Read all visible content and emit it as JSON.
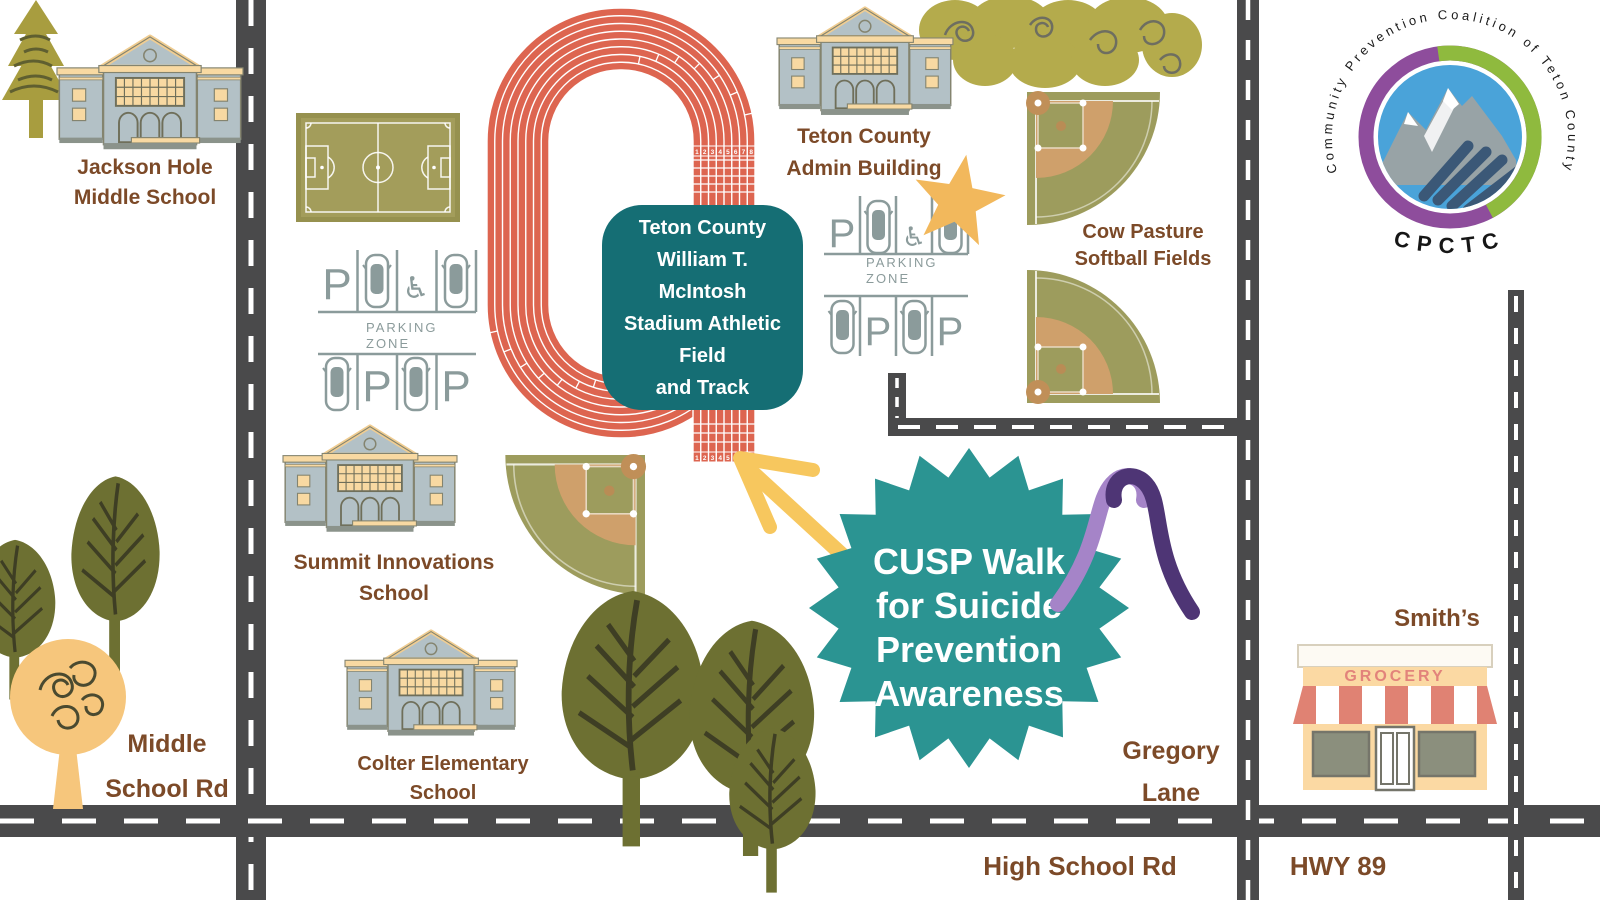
{
  "palette": {
    "road": "#4a4a4b",
    "track_orange": "#dd6550",
    "field_olive": "#9d9c5d",
    "infield_tan": "#cfa06b",
    "label_brown": "#7c4a28",
    "stadium_teal": "#156e74",
    "badge_teal": "#2b9492",
    "arrow_yellow": "#f7c75e",
    "star_yellow": "#f2b85c",
    "ribbon_light_purple": "#a584c8",
    "ribbon_dark_purple": "#4e3575",
    "parking_gray": "#8b9b9b",
    "building_body": "#b3c1c6",
    "building_trim": "#f8d9a2",
    "grocery_red": "#e08273",
    "logo_purple": "#8e4d9c",
    "logo_green": "#8fba3e",
    "logo_blue": "#4aa3d9"
  },
  "logo": {
    "circle_text": "Community Prevention Coalition of Teton County",
    "acronym": "CPCTC"
  },
  "stadium_box": {
    "lines": [
      "Teton County",
      "William T.",
      "McIntosh",
      "Stadium Athletic",
      "Field",
      "and Track"
    ]
  },
  "event_badge": {
    "lines": [
      "CUSP Walk",
      "for Suicide",
      "Prevention",
      "Awareness"
    ]
  },
  "locations": {
    "jackson_hole_middle_school": {
      "line1": "Jackson Hole",
      "line2": "Middle School"
    },
    "teton_county_admin": {
      "line1": "Teton County",
      "line2": "Admin Building"
    },
    "cow_pasture": {
      "line1": "Cow Pasture",
      "line2": "Softball Fields"
    },
    "summit_innovations": {
      "line1": "Summit Innovations",
      "line2": "School"
    },
    "colter_elementary": {
      "line1": "Colter Elementary",
      "line2": "School"
    },
    "smiths": {
      "name": "Smith’s",
      "sign": "GROCERY"
    }
  },
  "roads": {
    "middle_school_rd": {
      "line1": "Middle",
      "line2": "School Rd"
    },
    "gregory_lane": {
      "line1": "Gregory",
      "line2": "Lane"
    },
    "high_school_rd": {
      "label": "High School Rd"
    },
    "hwy_89": {
      "label": "HWY 89"
    }
  },
  "parking": {
    "symbol": "P",
    "zone_line1": "PARKING",
    "zone_line2": "ZONE",
    "handicap_icon": "♿"
  },
  "track": {
    "lane_numbers": [
      "1",
      "2",
      "3",
      "4",
      "5",
      "6",
      "7",
      "8"
    ]
  }
}
